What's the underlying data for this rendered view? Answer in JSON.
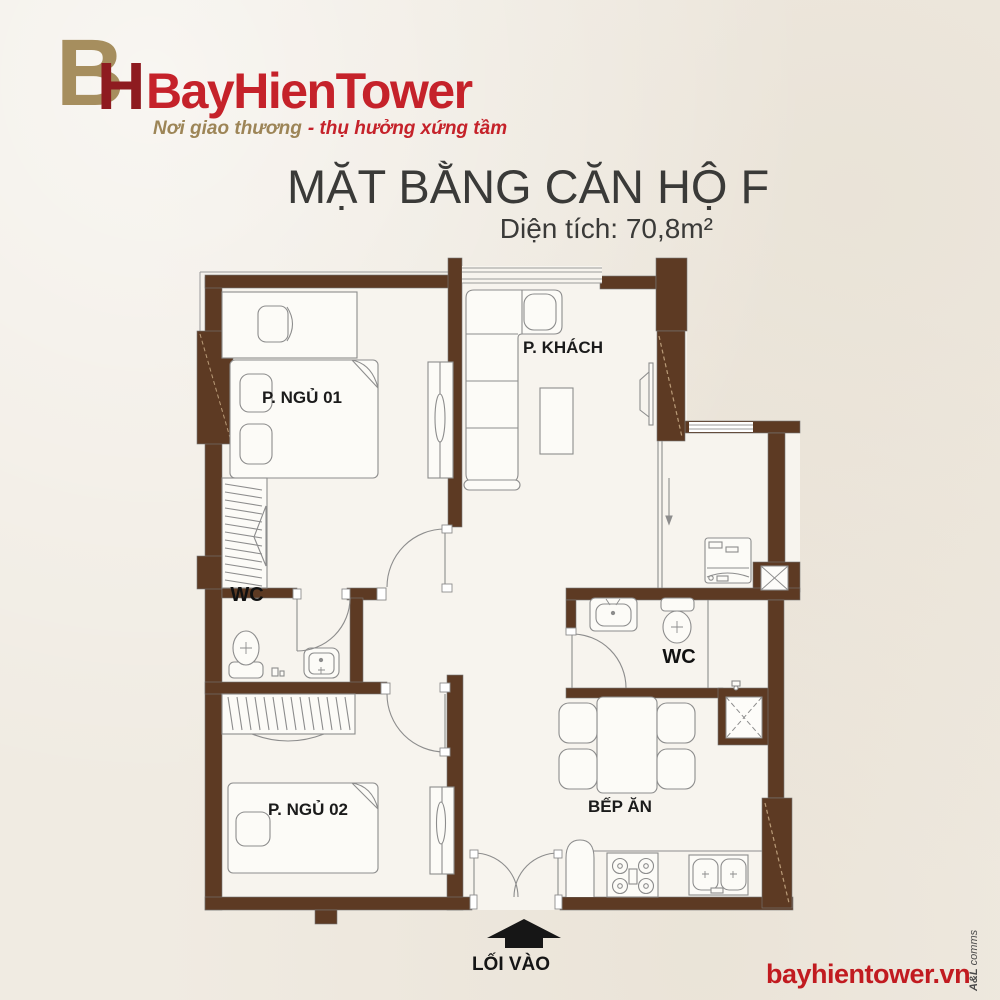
{
  "brand": {
    "monogram": {
      "b": "B",
      "h": "H"
    },
    "name": "BayHienTower",
    "tagline": {
      "gold": "Nơi giao thương",
      "red": "- thụ hưởng xứng tầm"
    }
  },
  "title": {
    "heading": "MẶT BẰNG CĂN HỘ F",
    "area": "Diện tích: 70,8m²"
  },
  "floorplan": {
    "labels": {
      "bedroom1": "P. NGỦ 01",
      "living_room": "P. KHÁCH",
      "wc1": "WC",
      "wc2": "WC",
      "bedroom2": "P. NGỦ 02",
      "kitchen": "BẾP ĂN",
      "entrance": "LỐI VÀO"
    }
  },
  "footer": {
    "website": "bayhientower.vn",
    "credit_bold": "A&L",
    "credit_rest": "comms"
  },
  "colors": {
    "background": "#f0ebe2",
    "wall_brown": "#5d3a23",
    "floor_fill": "#f7f4ee",
    "furniture_line": "#8d8d8d",
    "brand_red": "#c5222a",
    "brand_gold": "#a68e5e",
    "website_red": "#c11b20",
    "label_text": "#1b1b1b",
    "arrow_black": "#161616"
  }
}
